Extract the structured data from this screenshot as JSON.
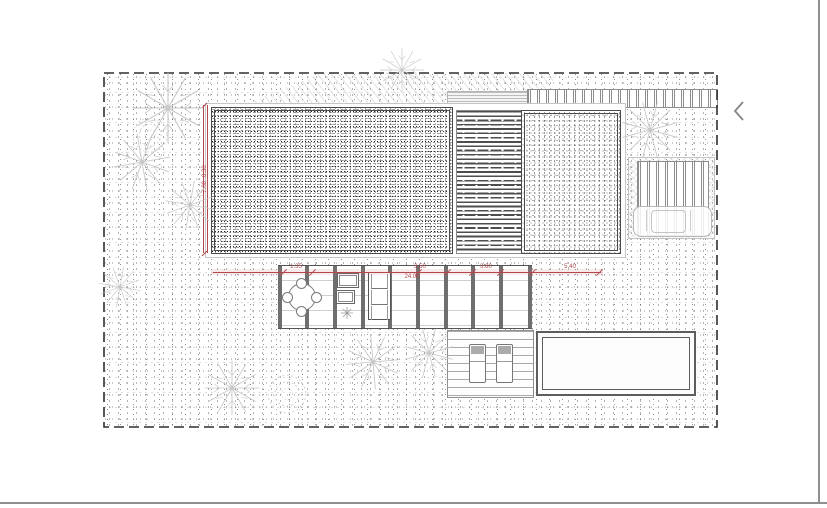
{
  "viewer": {
    "prev_button_icon": "chevron-left-icon",
    "frame_color": "#8f8f8f"
  },
  "plan": {
    "type": "architectural-site-plan",
    "accent_color": "#b0484e",
    "h_dims": {
      "seg1": "1.35",
      "seg2": "3.50",
      "seg3": "3.80",
      "seg4": "5.40",
      "total": "24.06"
    },
    "v_dims": {
      "dim1": "7.00",
      "dim2": "8.30"
    }
  }
}
